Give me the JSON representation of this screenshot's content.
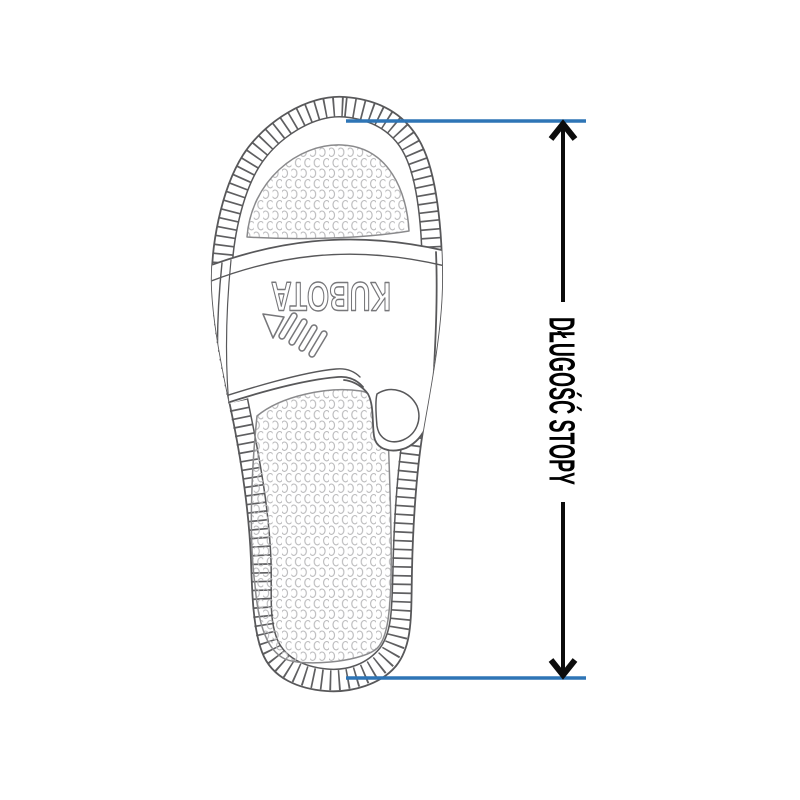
{
  "page": {
    "background": "#ffffff",
    "description": "Shoe size guide diagram: top view line drawing of a slide sandal with foot-length measurement arrow"
  },
  "illustration": {
    "name": "slide-sandal-top-view",
    "brand_text": "KUBOTA",
    "outline_color": "#58585a",
    "tread_tick_color": "#5f5f61",
    "footbed_dot_color": "#b9b9bb",
    "footbed_edge_color": "#8a8a8c",
    "logo_outline_color": "#77777a"
  },
  "measurement": {
    "label": "DŁUGOŚĆ STOPY",
    "label_color": "#000000",
    "arrow_color": "#0c0c0c",
    "extent_line_color": "#2e75b6"
  }
}
